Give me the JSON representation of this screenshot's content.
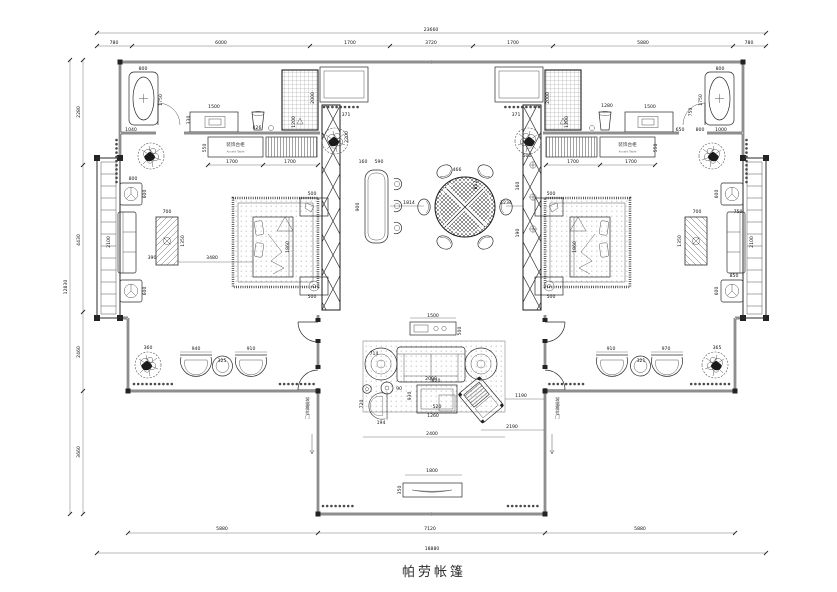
{
  "title": {
    "text": "帕劳帐篷"
  },
  "labels": {
    "accent_table_left_cn": "装饰台柜",
    "accent_table_left_en": "Accent Table",
    "accent_table_right_cn": "装饰台柜",
    "accent_table_right_en": "Accent Table",
    "sliding_door_left": "玻璃推拉门",
    "sliding_door_right": "玻璃推拉门"
  },
  "dimensions": {
    "top_overall": "23660",
    "top_segments": [
      "780",
      "6000",
      "1700",
      "3720",
      "1700",
      "5880",
      "780"
    ],
    "left_overall": "12830",
    "left_segments": [
      "2280",
      "4430",
      "2460",
      "3660"
    ],
    "bottom_segments": [
      "5880",
      "7120",
      "5880"
    ],
    "bottom_overall": "18880"
  },
  "annotations": [
    {
      "t": "23660",
      "x": 431,
      "y": 31
    },
    {
      "t": "780",
      "x": 114,
      "y": 44
    },
    {
      "t": "6000",
      "x": 221,
      "y": 44
    },
    {
      "t": "1700",
      "x": 350,
      "y": 44
    },
    {
      "t": "3720",
      "x": 431,
      "y": 44
    },
    {
      "t": "1700",
      "x": 513,
      "y": 44
    },
    {
      "t": "5880",
      "x": 643,
      "y": 44
    },
    {
      "t": "780",
      "x": 749,
      "y": 44
    },
    {
      "t": "12830",
      "x": 67,
      "y": 287,
      "r": -90
    },
    {
      "t": "2280",
      "x": 80,
      "y": 112,
      "r": -90
    },
    {
      "t": "4430",
      "x": 80,
      "y": 240,
      "r": -90
    },
    {
      "t": "2460",
      "x": 80,
      "y": 352,
      "r": -90
    },
    {
      "t": "3660",
      "x": 80,
      "y": 452,
      "r": -90
    },
    {
      "t": "5880",
      "x": 222,
      "y": 530
    },
    {
      "t": "7120",
      "x": 430,
      "y": 530
    },
    {
      "t": "5880",
      "x": 640,
      "y": 530
    },
    {
      "t": "18880",
      "x": 432,
      "y": 550
    },
    {
      "t": "800",
      "x": 143,
      "y": 70
    },
    {
      "t": "1750",
      "x": 162,
      "y": 100,
      "r": -90
    },
    {
      "t": "1040",
      "x": 131,
      "y": 131
    },
    {
      "t": "1500",
      "x": 214,
      "y": 108
    },
    {
      "t": "330",
      "x": 190,
      "y": 120,
      "r": -90
    },
    {
      "t": "426",
      "x": 257,
      "y": 129
    },
    {
      "t": "1200",
      "x": 295,
      "y": 122,
      "r": -90
    },
    {
      "t": "2000",
      "x": 314,
      "y": 98,
      "r": -90
    },
    {
      "t": "550",
      "x": 206,
      "y": 148,
      "r": -90
    },
    {
      "t": "1700",
      "x": 232,
      "y": 163
    },
    {
      "t": "1700",
      "x": 290,
      "y": 163
    },
    {
      "t": "800",
      "x": 720,
      "y": 70
    },
    {
      "t": "1750",
      "x": 702,
      "y": 100,
      "r": -90
    },
    {
      "t": "2000",
      "x": 549,
      "y": 98,
      "r": -90
    },
    {
      "t": "1200",
      "x": 568,
      "y": 122,
      "r": -90
    },
    {
      "t": "1280",
      "x": 607,
      "y": 107
    },
    {
      "t": "1500",
      "x": 650,
      "y": 108
    },
    {
      "t": "750",
      "x": 692,
      "y": 112,
      "r": -90
    },
    {
      "t": "650",
      "x": 680,
      "y": 131
    },
    {
      "t": "800",
      "x": 700,
      "y": 131
    },
    {
      "t": "1000",
      "x": 721,
      "y": 131
    },
    {
      "t": "550",
      "x": 657,
      "y": 148,
      "r": -90
    },
    {
      "t": "1700",
      "x": 573,
      "y": 163
    },
    {
      "t": "1700",
      "x": 631,
      "y": 163
    },
    {
      "t": "500",
      "x": 312,
      "y": 195
    },
    {
      "t": "500",
      "x": 312,
      "y": 298
    },
    {
      "t": "1860",
      "x": 289,
      "y": 247,
      "r": -90
    },
    {
      "t": "3480",
      "x": 212,
      "y": 259
    },
    {
      "t": "390",
      "x": 152,
      "y": 259
    },
    {
      "t": "700",
      "x": 167,
      "y": 213
    },
    {
      "t": "1350",
      "x": 184,
      "y": 241,
      "r": -90
    },
    {
      "t": "2100",
      "x": 110,
      "y": 242,
      "r": -90
    },
    {
      "t": "600",
      "x": 146,
      "y": 194,
      "r": -90
    },
    {
      "t": "600",
      "x": 146,
      "y": 291,
      "r": -90
    },
    {
      "t": "800",
      "x": 133,
      "y": 180
    },
    {
      "t": "500",
      "x": 551,
      "y": 195
    },
    {
      "t": "500",
      "x": 551,
      "y": 298
    },
    {
      "t": "1860",
      "x": 576,
      "y": 247,
      "r": -90
    },
    {
      "t": "700",
      "x": 697,
      "y": 213
    },
    {
      "t": "1350",
      "x": 681,
      "y": 241,
      "r": -90
    },
    {
      "t": "2100",
      "x": 753,
      "y": 242,
      "r": -90
    },
    {
      "t": "600",
      "x": 718,
      "y": 194,
      "r": -90
    },
    {
      "t": "600",
      "x": 718,
      "y": 291,
      "r": -90
    },
    {
      "t": "750",
      "x": 738,
      "y": 213
    },
    {
      "t": "850",
      "x": 734,
      "y": 277
    },
    {
      "t": "371",
      "x": 346,
      "y": 116
    },
    {
      "t": "371",
      "x": 516,
      "y": 116
    },
    {
      "t": "2200",
      "x": 348,
      "y": 137,
      "r": -90
    },
    {
      "t": "160",
      "x": 363,
      "y": 163
    },
    {
      "t": "590",
      "x": 379,
      "y": 163
    },
    {
      "t": "900",
      "x": 359,
      "y": 207,
      "r": -90
    },
    {
      "t": "1814",
      "x": 409,
      "y": 204
    },
    {
      "t": "466",
      "x": 457,
      "y": 171
    },
    {
      "t": "812",
      "x": 477,
      "y": 185,
      "r": -90
    },
    {
      "t": "1234",
      "x": 506,
      "y": 204
    },
    {
      "t": "500",
      "x": 527,
      "y": 157
    },
    {
      "t": "160",
      "x": 519,
      "y": 186,
      "r": -90
    },
    {
      "t": "190",
      "x": 519,
      "y": 233,
      "r": -90
    },
    {
      "t": "1500",
      "x": 433,
      "y": 317
    },
    {
      "t": "500",
      "x": 461,
      "y": 331,
      "r": -90
    },
    {
      "t": "714",
      "x": 374,
      "y": 355
    },
    {
      "t": "2000",
      "x": 431,
      "y": 380
    },
    {
      "t": "820",
      "x": 436,
      "y": 382
    },
    {
      "t": "930",
      "x": 411,
      "y": 396,
      "r": -90
    },
    {
      "t": "520",
      "x": 437,
      "y": 408
    },
    {
      "t": "1260",
      "x": 433,
      "y": 417
    },
    {
      "t": "720",
      "x": 363,
      "y": 404,
      "r": -90
    },
    {
      "t": "194",
      "x": 381,
      "y": 424
    },
    {
      "t": "90",
      "x": 399,
      "y": 390
    },
    {
      "t": "2400",
      "x": 432,
      "y": 435
    },
    {
      "t": "2190",
      "x": 512,
      "y": 428
    },
    {
      "t": "1190",
      "x": 521,
      "y": 397
    },
    {
      "t": "1800",
      "x": 432,
      "y": 472
    },
    {
      "t": "350",
      "x": 401,
      "y": 490,
      "r": -90
    },
    {
      "t": "360",
      "x": 148,
      "y": 349
    },
    {
      "t": "940",
      "x": 196,
      "y": 350
    },
    {
      "t": "325",
      "x": 222,
      "y": 362
    },
    {
      "t": "910",
      "x": 251,
      "y": 350
    },
    {
      "t": "910",
      "x": 611,
      "y": 350
    },
    {
      "t": "321",
      "x": 641,
      "y": 362
    },
    {
      "t": "970",
      "x": 666,
      "y": 350
    },
    {
      "t": "365",
      "x": 717,
      "y": 349
    }
  ]
}
